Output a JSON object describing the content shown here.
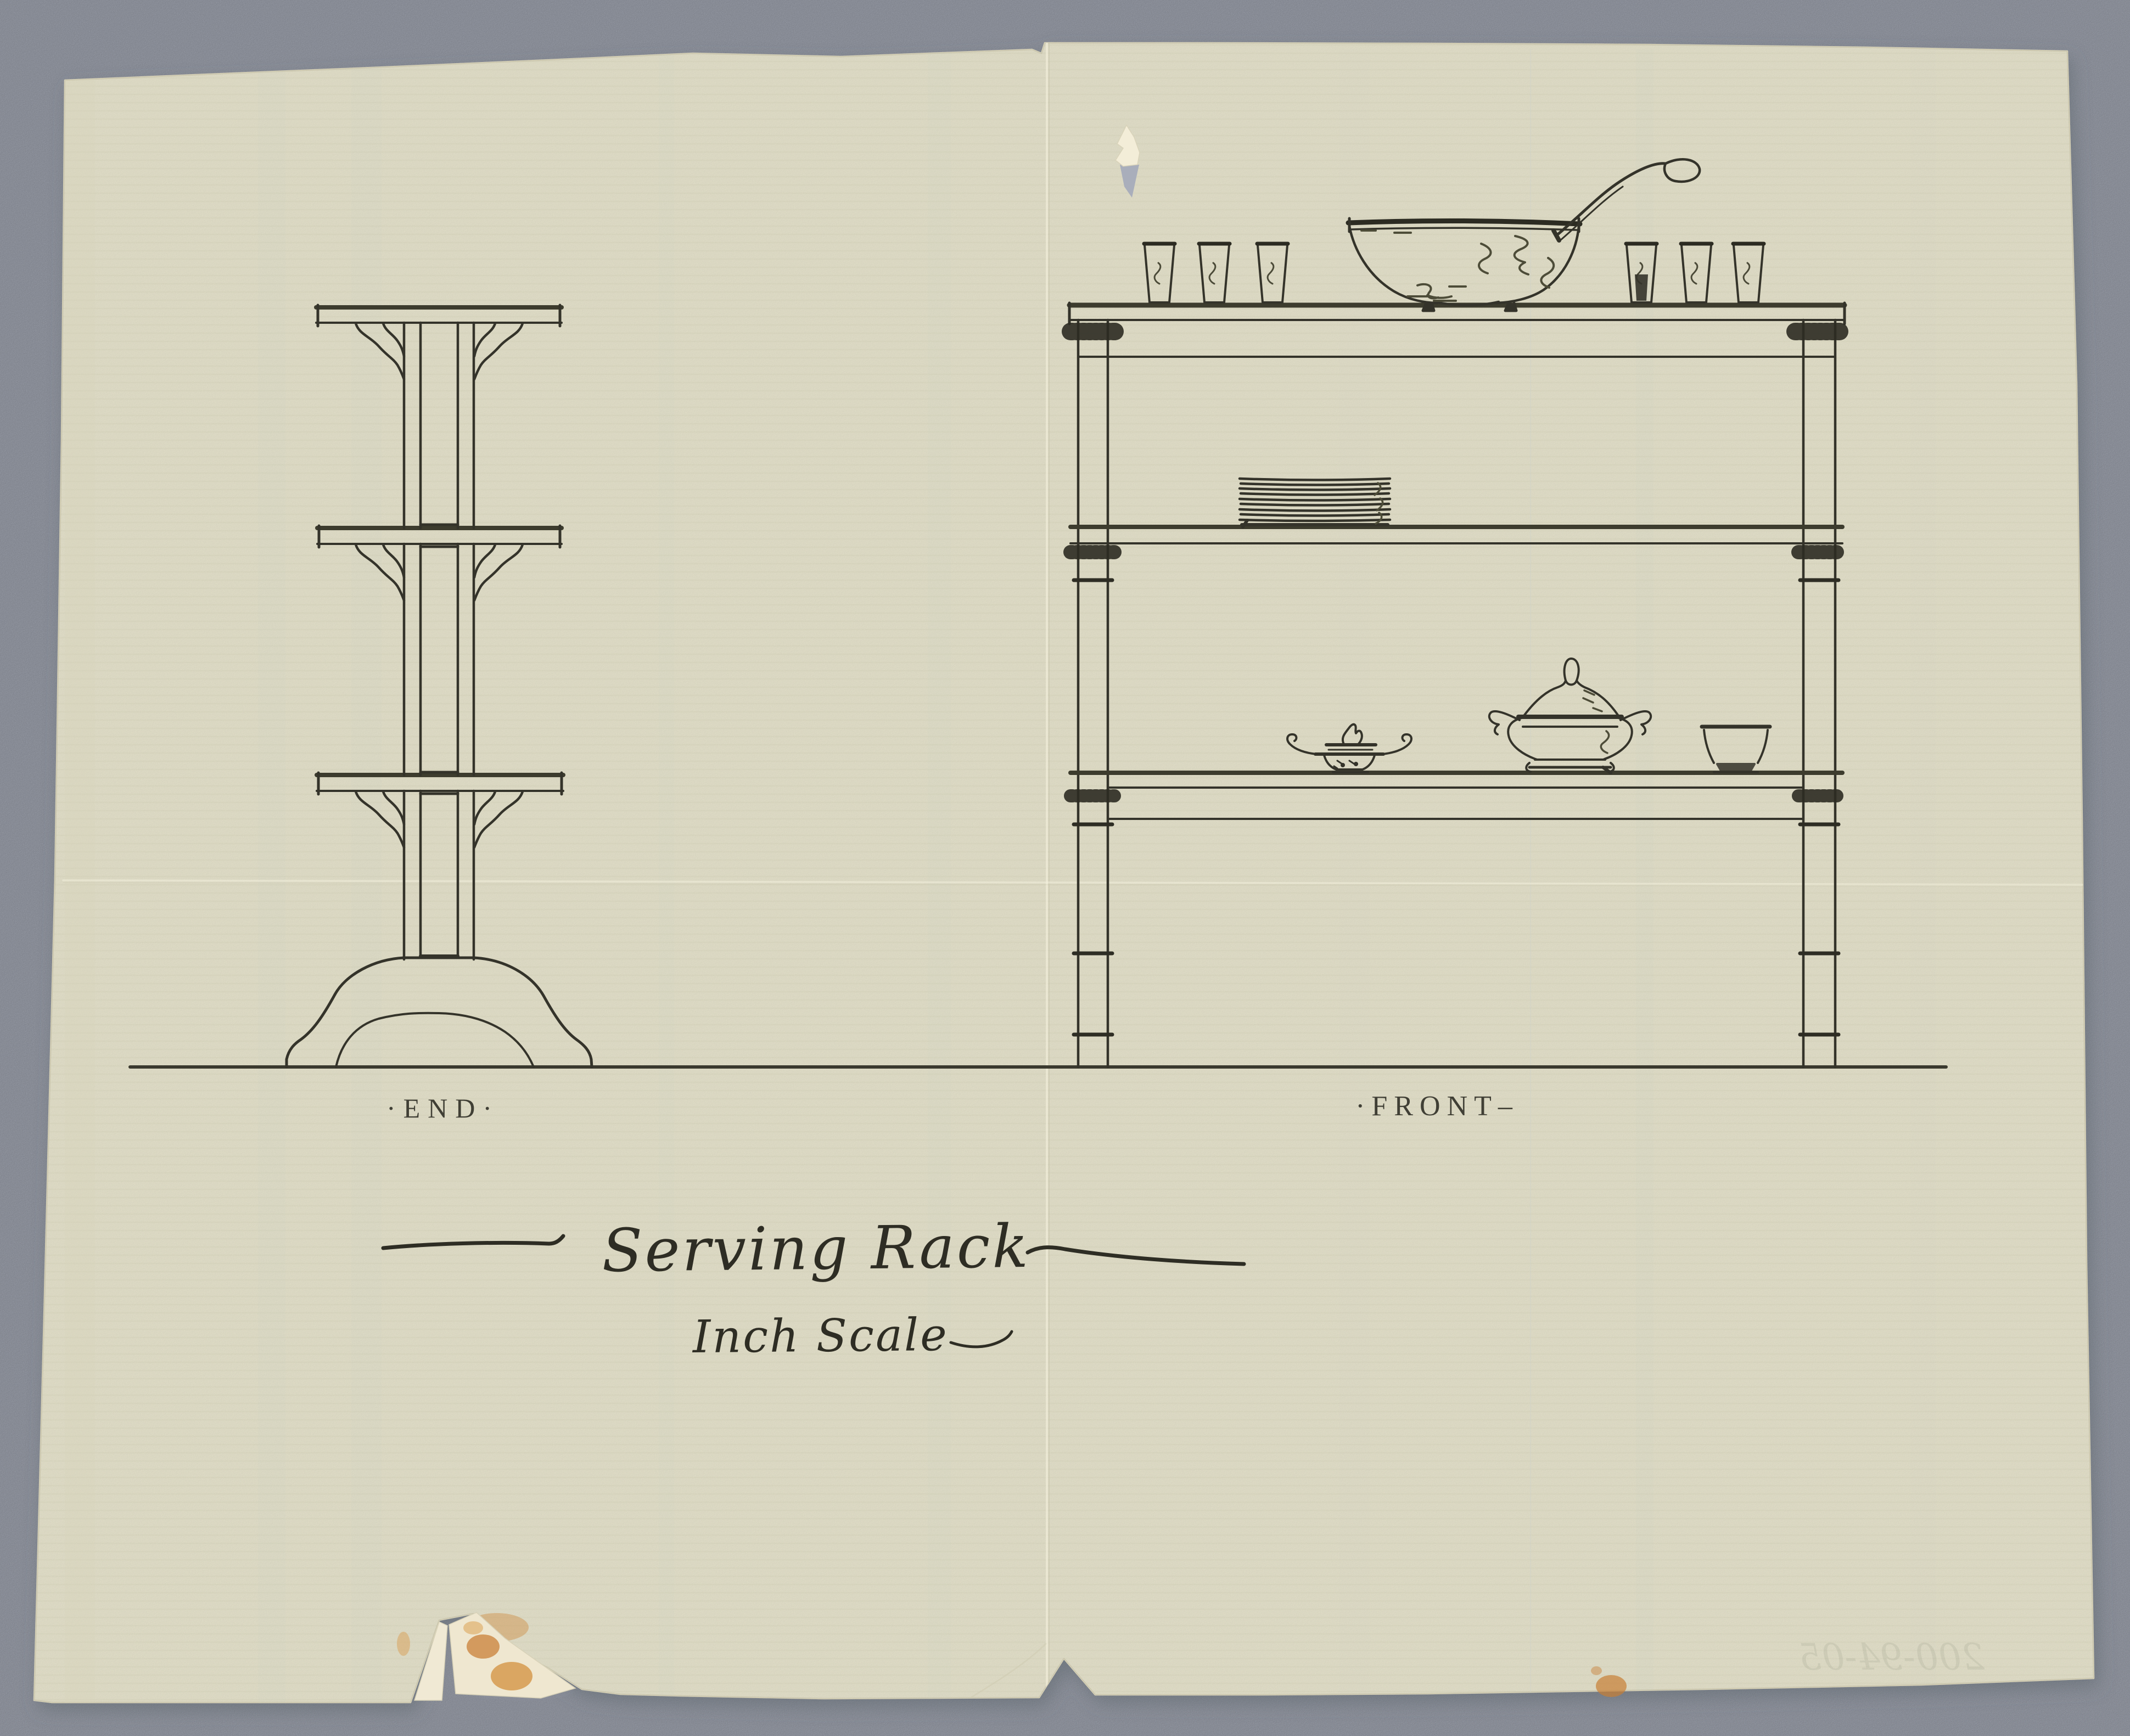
{
  "scan": {
    "background_color": "#a6abb7",
    "paper_color": "#eae7d0",
    "ink_color": "#34332a",
    "stain_color": "#c9823d"
  },
  "drawing": {
    "title": "Serving Rack",
    "scale_label": "Inch Scale",
    "end_view_label": "·END·",
    "front_view_label": "·FRONT–",
    "verso_inscription": "200-94-05"
  }
}
